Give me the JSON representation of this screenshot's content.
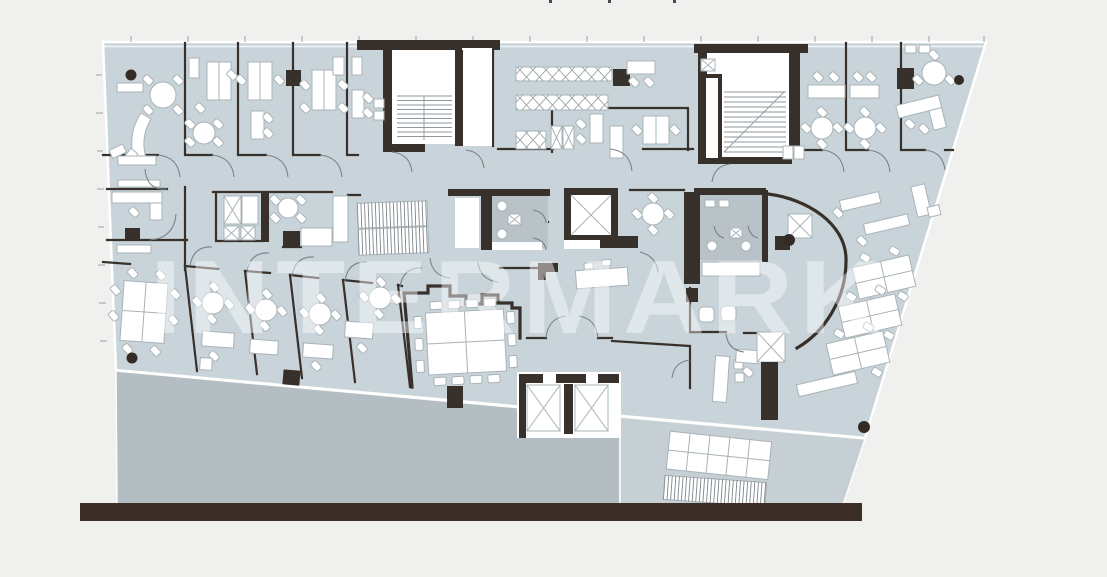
{
  "watermark": {
    "text": "INTERMARK",
    "color": "#ffffff",
    "opacity": "0.45"
  },
  "palette": {
    "background": "#f0f0ef",
    "floor": "#c8d4d9",
    "wall": "#38302b",
    "furniture_fill": "#ffffff",
    "furniture_stroke": "#a9b3b7",
    "wc_floor": "#b9c2c6",
    "terrace": "#b4bdc1",
    "balcony": "#c6cfd4",
    "base_bar": "#3a2e27",
    "door_arc": "#78828a",
    "tick": "#9aa0a3",
    "plant": "#322b26",
    "watermark_color": "#ffffff"
  }
}
